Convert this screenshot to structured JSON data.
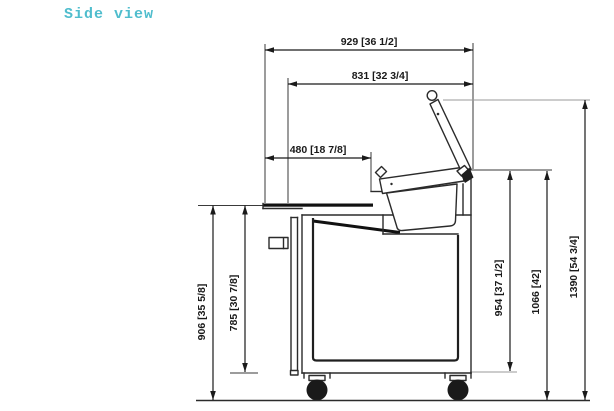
{
  "title": "Side view",
  "colors": {
    "accent": "#4fbdcd",
    "line": "#1a1a1a",
    "background": "#ffffff"
  },
  "figure": {
    "type": "technical-drawing",
    "view": "side",
    "subject": "refrigerated prep counter with open lid, food pan, door and casters"
  },
  "dims": {
    "d929": "929 [36 1/2]",
    "d831": "831 [32 3/4]",
    "d480": "480 [18 7/8]",
    "d906": "906 [35 5/8]",
    "d785": "785 [30 7/8]",
    "d954": "954 [37 1/2]",
    "d1066": "1066 [42]",
    "d1390": "1390 [54 3/4]"
  }
}
